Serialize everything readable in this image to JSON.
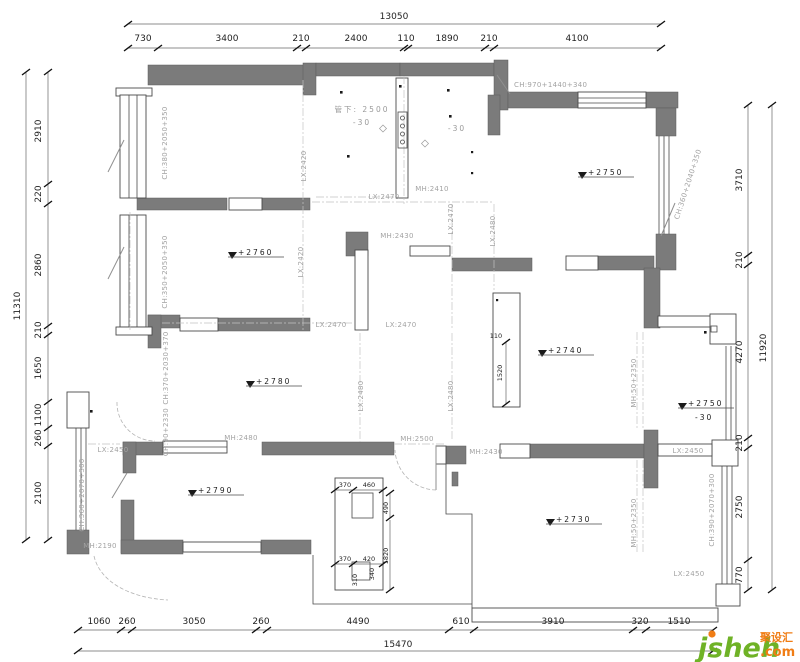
{
  "dims": {
    "top_total": "13050",
    "top": [
      "730",
      "3400",
      "210",
      "2400",
      "110",
      "1890",
      "210",
      "4100"
    ],
    "left_total": "11310",
    "left": [
      "2910",
      "220",
      "2860",
      "210",
      "1650",
      "1100",
      "260",
      "2100"
    ],
    "right_total": "11920",
    "right": [
      "3710",
      "210",
      "4270",
      "210",
      "2750",
      "770"
    ],
    "bottom_total": "15470",
    "bottom": [
      "1060",
      "260",
      "3050",
      "260",
      "4490",
      "610",
      "3910",
      "320",
      "1510"
    ]
  },
  "labels": {
    "door_head": "CH:970+1440+340",
    "win_left_top": "CH:380+2050+350",
    "win_left_mid": "CH:350+2050+350",
    "win_left_low": "CH:370+2030+370",
    "win_left_small": "CH:90+2330",
    "win_balcony_left": "CH:360+2070+300",
    "win_right_top": "CH:360+2040+350",
    "win_right_bottom": "CH:390+2070+300",
    "mh_2410": "MH:2410",
    "mh_2430": "MH:2430",
    "mh_2480": "MH:2480",
    "mh_2190": "MH:2190",
    "mh_2500": "MH:2500",
    "mh_50_2350": "MH:50+2350",
    "lx_2420": "LX:2420",
    "lx_2450": "LX:2450",
    "lx_2470": "LX:2470",
    "lx_2480": "LX:2480"
  },
  "levels": {
    "room_left": "+2760",
    "room_tr": "+2750",
    "living": "+2780",
    "dining": "+2740",
    "master": "+2790",
    "room_br": "+2730",
    "balcony": "+2750",
    "balcony_offset": "-30",
    "utility_offset": "-30"
  },
  "notes": {
    "pipe_l1": "管下: 2500",
    "pipe_l2": "-30"
  },
  "island": {
    "width_dim": "110",
    "length_dim": "1520"
  },
  "cab": [
    "370",
    "460",
    "490",
    "1820",
    "370",
    "420",
    "340",
    "310"
  ],
  "watermark": {
    "brand": "jsheh",
    "cn": "聚设汇",
    "tld": ".com"
  }
}
